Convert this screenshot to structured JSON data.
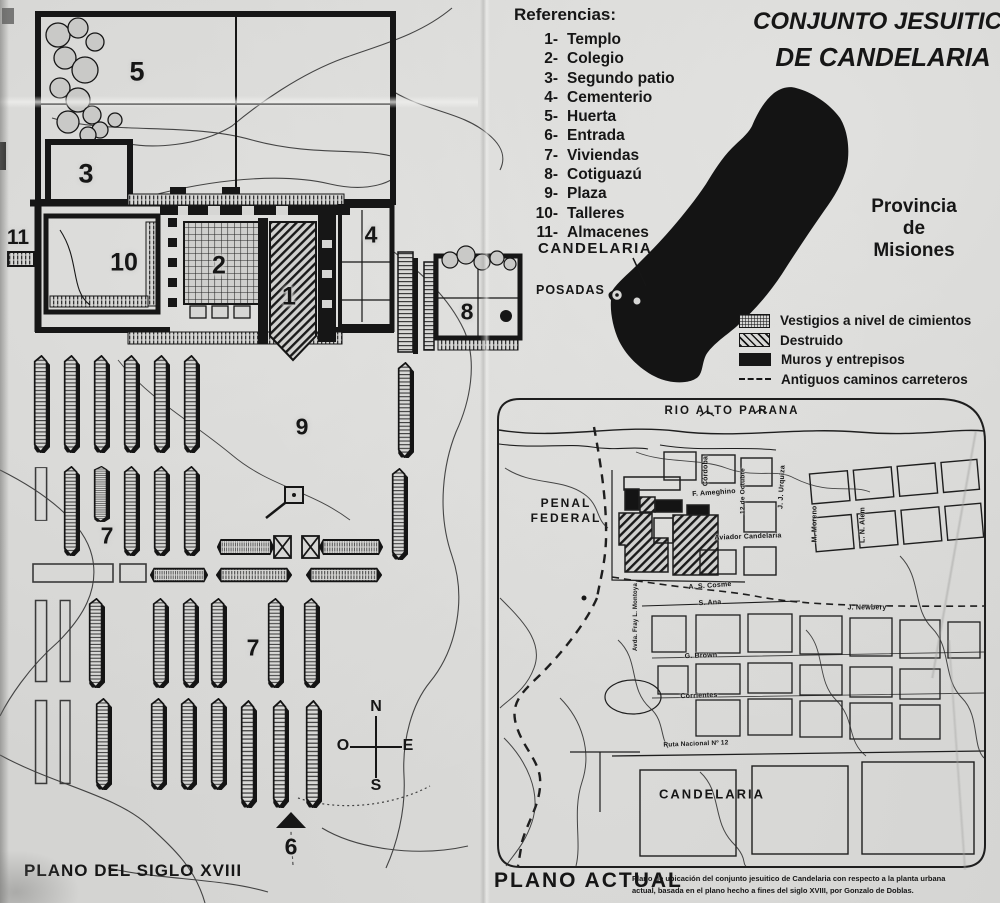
{
  "title": {
    "line1": "CONJUNTO JESUITICO",
    "line2": "DE CANDELARIA"
  },
  "references": {
    "heading": "Referencias:",
    "items": [
      {
        "num": "1-",
        "label": "Templo"
      },
      {
        "num": "2-",
        "label": "Colegio"
      },
      {
        "num": "3-",
        "label": "Segundo patio"
      },
      {
        "num": "4-",
        "label": "Cementerio"
      },
      {
        "num": "5-",
        "label": "Huerta"
      },
      {
        "num": "6-",
        "label": "Entrada"
      },
      {
        "num": "7-",
        "label": "Viviendas"
      },
      {
        "num": "8-",
        "label": "Cotiguazú"
      },
      {
        "num": "9-",
        "label": "Plaza"
      },
      {
        "num": "10-",
        "label": "Talleres"
      },
      {
        "num": "11-",
        "label": "Almacenes"
      }
    ]
  },
  "province": {
    "candelaria": "CANDELARIA",
    "posadas": "POSADAS",
    "name_lines": [
      "Provincia",
      "de",
      "Misiones"
    ]
  },
  "legend": {
    "items": [
      {
        "swatch": "stipple",
        "label": "Vestigios a nivel de cimientos"
      },
      {
        "swatch": "hatch",
        "label": "Destruido"
      },
      {
        "swatch": "solid",
        "label": "Muros y entrepisos"
      },
      {
        "swatch": "dash",
        "label": "Antiguos caminos carreteros"
      }
    ]
  },
  "old_plan": {
    "title": "PLANO DEL SIGLO XVIII",
    "numbers": {
      "n1": "1",
      "n2": "2",
      "n3": "3",
      "n4": "4",
      "n5": "5",
      "n6": "6",
      "n7": "7",
      "n8": "8",
      "n9": "9",
      "n10": "10",
      "n11": "11"
    },
    "compass": {
      "n": "N",
      "e": "E",
      "s": "S",
      "o": "O"
    }
  },
  "current_plan": {
    "title": "PLANO ACTUAL",
    "river": "RIO ALTO PARANA",
    "penal_lines": [
      "PENAL",
      "FEDERAL"
    ],
    "city": "CANDELARIA",
    "streets": {
      "cordoba": "Córdoba",
      "ameghino": "F. Ameghino",
      "octubre": "12 de Octubre",
      "urquiza": "J. J. Urquiza",
      "moreno": "M. Moreno",
      "alem": "L. N. Alem",
      "aviador": "Aviador Candelaria",
      "montoya": "Avda. Fray L. Montoya",
      "cosme": "A. S. Cosme",
      "sana": "S. Ana",
      "brown": "G. Brown",
      "corrientes": "Corrientes",
      "newbery": "J. Newbery",
      "ruta": "Ruta Nacional Nº 12"
    },
    "caption_lines": [
      "Plano de ubicación del conjunto jesuitico de Candelaria con respecto a la planta urbana",
      "actual, basada en el plano hecho a fines del siglo XVIII, por Gonzalo de Doblas."
    ]
  }
}
